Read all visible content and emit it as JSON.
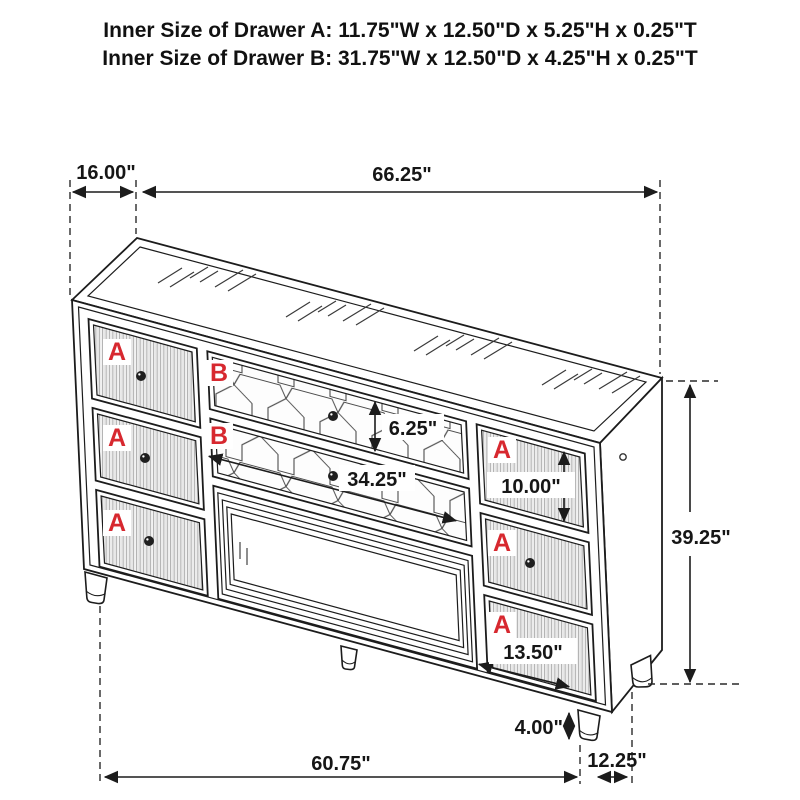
{
  "header": {
    "line_a": "Inner Size of Drawer A: 11.75\"W x 12.50\"D x 5.25\"H x 0.25\"T",
    "line_b": "Inner Size of Drawer B: 31.75\"W x 12.50\"D x 4.25\"H x 0.25\"T"
  },
  "drawer_labels": {
    "a": "A",
    "b": "B"
  },
  "dims": {
    "top_depth": "16.00\"",
    "top_width": "66.25\"",
    "b_height": "6.25\"",
    "b_width": "34.25\"",
    "a_height": "10.00\"",
    "a_width": "13.50\"",
    "overall_height": "39.25\"",
    "leg_height": "4.00\"",
    "base_width": "60.75\"",
    "base_depth": "12.25\""
  },
  "colors": {
    "label_red": "#d7282f",
    "line_black": "#1c1c1c",
    "background": "#ffffff"
  }
}
